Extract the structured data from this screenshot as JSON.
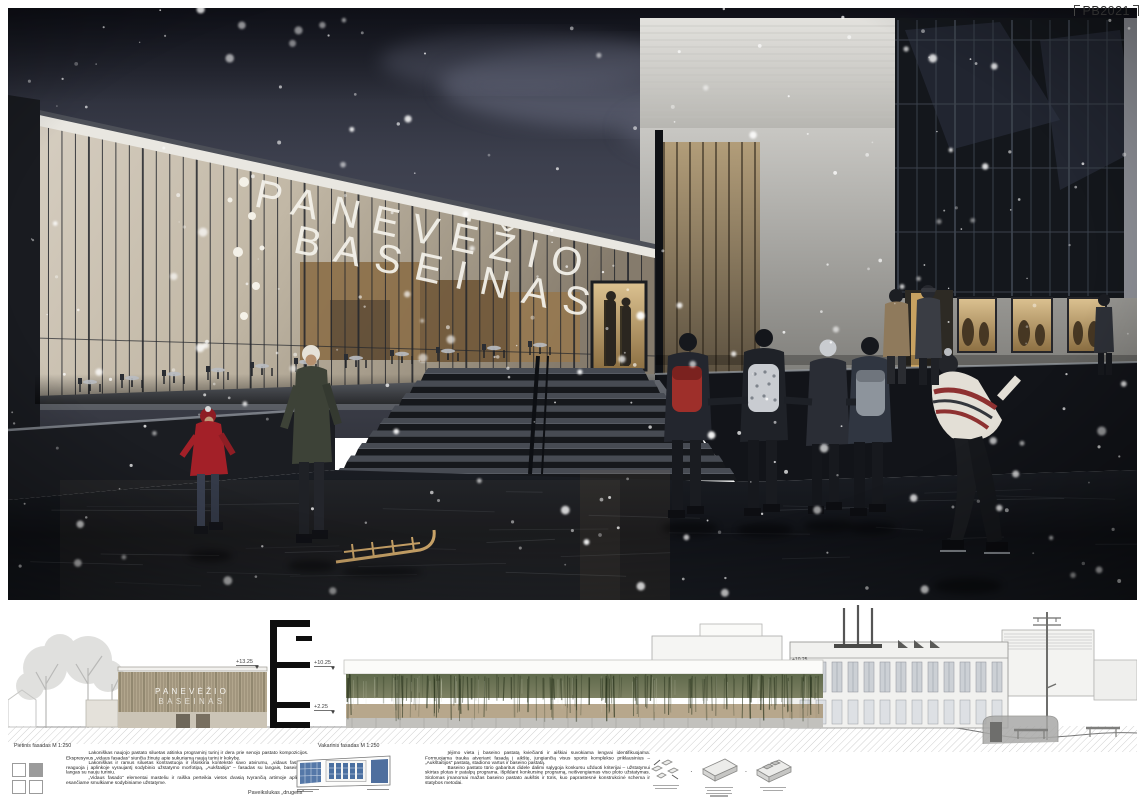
{
  "board": {
    "tag": "PB2021"
  },
  "render": {
    "sign_line1": "PANEVĖŽIO",
    "sign_line2": "BASEINAS"
  },
  "elevations": {
    "south": {
      "label": "Pietinis fasadas M 1:250",
      "facade_line1": "PANEVĖŽIO",
      "facade_line2": "BASEINAS",
      "level_mark": "+13.25"
    },
    "section": {
      "upper_mark": "+10.25",
      "lower_mark": "+2.25"
    },
    "west": {
      "label": "Vakarinis fasadas M 1:250",
      "building_mark": "+10.25"
    }
  },
  "texts": {
    "left_paragraphs": [
      "Lakoniškas naujojo pastato siluetas atitinka programinį turinį ir dera prie senojo pastato kompozicijos. Ekspresyvus „vidaus fasadas“ siunčia žinutę apie sukuriamą naują turinį ir kokybę.",
      "Lakoniškas ir ramus siluetas kontrastuoja ir išsiskiria kontekste savo atvirumu, „vidaus fasadas“ reaguoja į aplinkoje vyraujantį sodybinio užstatymo morfotipą, „Aukštaitija“ – fasadas su langais, baseinas – langas su nauju turiniu.",
      "„Vidaus fasado“ elementai masteliu ir raiška perteikia vietos dvasią tvyrančią artimoje aplinkoje esančiame smulkiame sodybiniame užstatyme."
    ],
    "center_paragraphs": [
      "Įėjimo vieta į baseino pastatą kviečianti ir aiškiai suvokiama lengvai identifikuojama. Formuojama trauka atveriant fasadą į aikštę, jungiančią visus sporto komplekso priklausinius – „Aukštaitijos“ pastatą, stadiono vartus ir baseino pastatą.",
      "Baseino pastato tūrio gabaritus didele dalimi sąlygoja konkursu užduoti kriterijai – užstatymui skirtas plotas ir patalpų programa. Išpildant konkursinę programą, neišvengiamas viso ploto užstatymas. Siūlomas įmanomai mažas baseino pastato aukštis ir tūris, kuo paprastesnė konstrukcinė schema ir statybos metodai."
    ]
  },
  "captions": {
    "painting": "Paveikslukas „drugelis“"
  },
  "colors": {
    "sky_dark": "#23252e",
    "facade_warm": "#cfc6b6",
    "ice_dark": "#101217",
    "accent_red": "#a32028",
    "green_wall": "#6b754f",
    "window_blue": "#4a6fa0"
  }
}
